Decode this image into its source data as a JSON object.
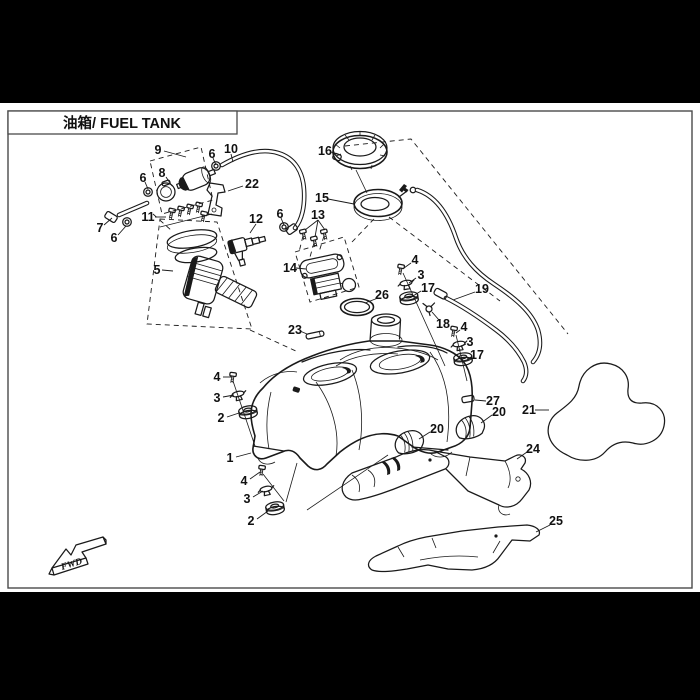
{
  "page": {
    "title": "油箱/ FUEL TANK",
    "fwd_label": "FWD",
    "colors": {
      "background": "#000000",
      "paper": "#ffffff",
      "line": "#1a1a1a"
    }
  },
  "callouts": [
    {
      "label": "9",
      "x": 158,
      "y": 150,
      "leaders": [
        [
          [
            164,
            151
          ],
          [
            186,
            157
          ]
        ]
      ]
    },
    {
      "label": "6",
      "x": 212,
      "y": 154,
      "leaders": [
        [
          [
            213,
            158
          ],
          [
            216,
            165
          ]
        ]
      ]
    },
    {
      "label": "10",
      "x": 231,
      "y": 149,
      "leaders": [
        [
          [
            231,
            154
          ],
          [
            233,
            162
          ]
        ]
      ]
    },
    {
      "label": "8",
      "x": 162,
      "y": 173,
      "leaders": [
        [
          [
            166,
            177
          ],
          [
            172,
            186
          ]
        ]
      ]
    },
    {
      "label": "22",
      "x": 252,
      "y": 184,
      "leaders": [
        [
          [
            243,
            186
          ],
          [
            228,
            191
          ]
        ]
      ]
    },
    {
      "label": "6",
      "x": 143,
      "y": 178,
      "leaders": [
        [
          [
            145,
            182
          ],
          [
            148,
            189
          ]
        ]
      ]
    },
    {
      "label": "7",
      "x": 100,
      "y": 228,
      "leaders": [
        [
          [
            104,
            225
          ],
          [
            112,
            218
          ]
        ]
      ]
    },
    {
      "label": "6",
      "x": 114,
      "y": 238,
      "leaders": [
        [
          [
            118,
            235
          ],
          [
            126,
            226
          ]
        ]
      ]
    },
    {
      "label": "11",
      "x": 148,
      "y": 217,
      "leaders": [
        [
          [
            155,
            217
          ],
          [
            166,
            217
          ]
        ]
      ]
    },
    {
      "label": "5",
      "x": 157,
      "y": 270,
      "leaders": [
        [
          [
            162,
            270
          ],
          [
            173,
            271
          ]
        ]
      ]
    },
    {
      "label": "12",
      "x": 256,
      "y": 219,
      "leaders": [
        [
          [
            256,
            224
          ],
          [
            250,
            233
          ]
        ]
      ]
    },
    {
      "label": "6",
      "x": 280,
      "y": 214,
      "leaders": [
        [
          [
            281,
            218
          ],
          [
            284,
            225
          ]
        ]
      ]
    },
    {
      "label": "13",
      "x": 318,
      "y": 215,
      "leaders": [
        [
          [
            318,
            220
          ],
          [
            305,
            230
          ]
        ],
        [
          [
            318,
            220
          ],
          [
            315,
            237
          ]
        ],
        [
          [
            318,
            220
          ],
          [
            325,
            230
          ]
        ]
      ]
    },
    {
      "label": "16",
      "x": 325,
      "y": 151,
      "leaders": [
        [
          [
            331,
            152
          ],
          [
            340,
            155
          ]
        ]
      ]
    },
    {
      "label": "15",
      "x": 322,
      "y": 198,
      "leaders": [
        [
          [
            328,
            199
          ],
          [
            354,
            204
          ]
        ]
      ]
    },
    {
      "label": "14",
      "x": 290,
      "y": 268,
      "leaders": [
        [
          [
            296,
            268
          ],
          [
            306,
            269
          ]
        ]
      ]
    },
    {
      "label": "26",
      "x": 382,
      "y": 295,
      "leaders": [
        [
          [
            378,
            298
          ],
          [
            365,
            303
          ]
        ]
      ]
    },
    {
      "label": "23",
      "x": 295,
      "y": 330,
      "leaders": [
        [
          [
            300,
            331
          ],
          [
            307,
            334
          ]
        ]
      ]
    },
    {
      "label": "4",
      "x": 415,
      "y": 260,
      "leaders": [
        [
          [
            411,
            263
          ],
          [
            404,
            268
          ]
        ]
      ]
    },
    {
      "label": "3",
      "x": 421,
      "y": 275,
      "leaders": [
        [
          [
            416,
            278
          ],
          [
            409,
            283
          ]
        ]
      ]
    },
    {
      "label": "17",
      "x": 428,
      "y": 288,
      "leaders": [
        [
          [
            421,
            291
          ],
          [
            413,
            296
          ]
        ]
      ]
    },
    {
      "label": "18",
      "x": 443,
      "y": 324,
      "leaders": [
        [
          [
            439,
            320
          ],
          [
            432,
            312
          ]
        ]
      ]
    },
    {
      "label": "19",
      "x": 482,
      "y": 289,
      "leaders": [
        [
          [
            475,
            292
          ],
          [
            453,
            300
          ]
        ]
      ]
    },
    {
      "label": "4",
      "x": 464,
      "y": 327,
      "leaders": [
        [
          [
            460,
            330
          ],
          [
            456,
            333
          ]
        ]
      ]
    },
    {
      "label": "3",
      "x": 470,
      "y": 342,
      "leaders": [
        [
          [
            466,
            344
          ],
          [
            462,
            346
          ]
        ]
      ]
    },
    {
      "label": "17",
      "x": 477,
      "y": 355,
      "leaders": [
        [
          [
            471,
            357
          ],
          [
            467,
            359
          ]
        ]
      ]
    },
    {
      "label": "20",
      "x": 437,
      "y": 429,
      "leaders": [
        [
          [
            430,
            432
          ],
          [
            419,
            439
          ]
        ]
      ]
    },
    {
      "label": "20",
      "x": 499,
      "y": 412,
      "leaders": [
        [
          [
            492,
            415
          ],
          [
            481,
            423
          ]
        ]
      ]
    },
    {
      "label": "27",
      "x": 493,
      "y": 401,
      "leaders": [
        [
          [
            486,
            401
          ],
          [
            475,
            400
          ]
        ]
      ]
    },
    {
      "label": "21",
      "x": 529,
      "y": 410,
      "leaders": [
        [
          [
            535,
            410
          ],
          [
            549,
            410
          ]
        ]
      ]
    },
    {
      "label": "24",
      "x": 533,
      "y": 449,
      "leaders": [
        [
          [
            527,
            452
          ],
          [
            517,
            459
          ]
        ]
      ]
    },
    {
      "label": "25",
      "x": 556,
      "y": 521,
      "leaders": [
        [
          [
            550,
            525
          ],
          [
            536,
            532
          ]
        ]
      ]
    },
    {
      "label": "4",
      "x": 217,
      "y": 377,
      "leaders": [
        [
          [
            223,
            377
          ],
          [
            231,
            377
          ]
        ]
      ]
    },
    {
      "label": "3",
      "x": 217,
      "y": 398,
      "leaders": [
        [
          [
            223,
            397
          ],
          [
            234,
            395
          ]
        ]
      ]
    },
    {
      "label": "2",
      "x": 221,
      "y": 418,
      "leaders": [
        [
          [
            227,
            417
          ],
          [
            239,
            413
          ]
        ]
      ]
    },
    {
      "label": "1",
      "x": 230,
      "y": 458,
      "leaders": [
        [
          [
            236,
            457
          ],
          [
            251,
            453
          ]
        ]
      ]
    },
    {
      "label": "4",
      "x": 244,
      "y": 481,
      "leaders": [
        [
          [
            250,
            479
          ],
          [
            260,
            472
          ]
        ]
      ]
    },
    {
      "label": "3",
      "x": 247,
      "y": 499,
      "leaders": [
        [
          [
            253,
            497
          ],
          [
            263,
            491
          ]
        ]
      ]
    },
    {
      "label": "2",
      "x": 251,
      "y": 521,
      "leaders": [
        [
          [
            257,
            519
          ],
          [
            268,
            511
          ]
        ]
      ]
    }
  ]
}
